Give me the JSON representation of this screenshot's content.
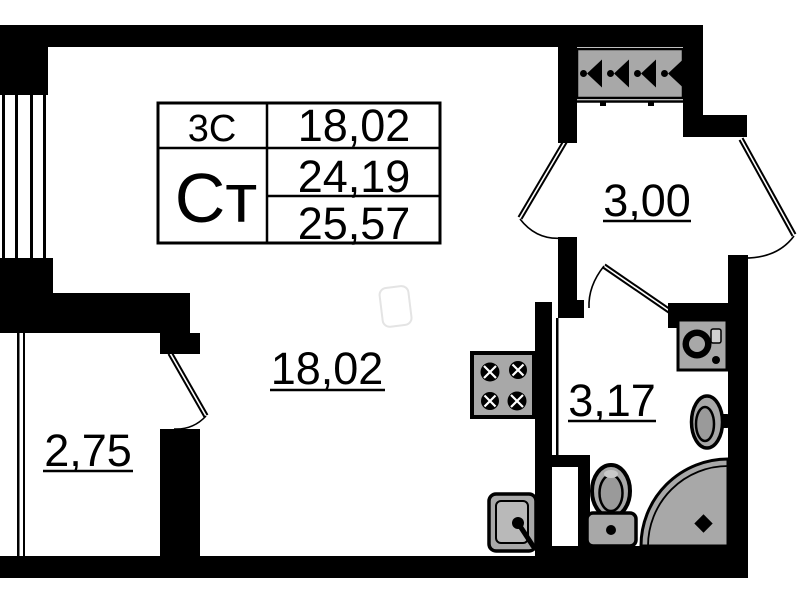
{
  "plan": {
    "type": "apartment-floor-plan",
    "colors": {
      "wall": "#000000",
      "background": "#ffffff",
      "fixture_fill": "#a8a8a8",
      "fixture_inner": "#b9b9b9",
      "fixture_dark": "#9a9a9a",
      "watermark": "#e4e4e4"
    },
    "info_table": {
      "rooms_code": "3С",
      "living_area": "18,02",
      "type_code": "Ст",
      "area_total": "24,19",
      "area_total_with_balcony": "25,57"
    },
    "rooms": {
      "living": {
        "area_label": "18,02"
      },
      "hallway": {
        "area_label": "3,00"
      },
      "bathroom": {
        "area_label": "3,17"
      },
      "balcony": {
        "area_label": "2,75"
      }
    },
    "fixtures": {
      "hallway": [
        "wardrobe-hanger-rack"
      ],
      "kitchen": [
        "stove-4-burner",
        "kitchen-sink"
      ],
      "bathroom": [
        "washing-machine",
        "washbasin",
        "toilet",
        "corner-shower"
      ]
    }
  }
}
